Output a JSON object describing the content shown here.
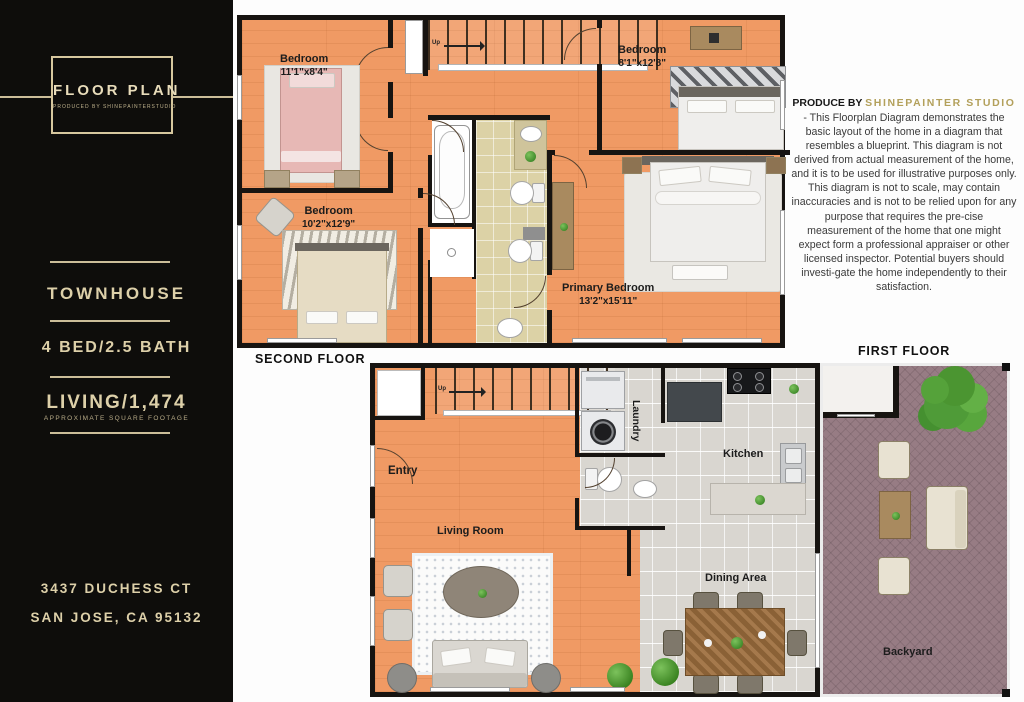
{
  "sidebar": {
    "logo_title": "FLOOR PLAN",
    "logo_subtitle": "PRODUCED BY SHINEPAINTERSTUDIO",
    "property_type": "TOWNHOUSE",
    "bed_bath": "4 BED/2.5 BATH",
    "living": "LIVING/1,474",
    "living_note": "APPROXIMATE SQUARE FOOTAGE",
    "address_line1": "3437 DUCHESS CT",
    "address_line2": "SAN JOSE, CA 95132"
  },
  "disclaimer": {
    "heading_prefix": "PRODUCE BY ",
    "heading_brand": "SHINEPAINTER STUDIO",
    "body": "- This Floorplan Diagram demonstrates the basic layout of the home in a diagram that resembles a blueprint. This diagram is not derived from actual measurement of the home, and it is to be used for illustrative purposes only. This diagram is not to scale, may contain inaccuracies and is not to be relied upon for any purpose that requires the pre-cise measurement of the home that one might expect form a professional appraiser or other licensed inspector. Potential buyers should investi-gate the home independently to their satisfaction."
  },
  "second_floor": {
    "label": "SECOND FLOOR",
    "stairs_label": "Up",
    "bedroom_top_left": {
      "name": "Bedroom",
      "dims": "11'1\"x8'4\""
    },
    "bedroom_mid_left": {
      "name": "Bedroom",
      "dims": "10'2\"x12'9\""
    },
    "bedroom_top_right": {
      "name": "Bedroom",
      "dims": "8'1\"x12'8\""
    },
    "primary_bedroom": {
      "name": "Primary Bedroom",
      "dims": "13'2\"x15'11\""
    }
  },
  "first_floor": {
    "label": "FIRST FLOOR",
    "stairs_label": "Up",
    "entry": "Entry",
    "living_room": "Living Room",
    "laundry": "Laundry",
    "kitchen": "Kitchen",
    "dining_area": "Dining Area",
    "backyard": "Backyard"
  },
  "colors": {
    "sidebar_bg": "#0e0d0b",
    "gold": "#d9cba3",
    "brand_gold": "#b3a05b",
    "wood_floor": "#f09a64",
    "bath_tile": "#dcd2a6",
    "kitchen_tile": "#e7e4de",
    "backyard_paving": "#977c84",
    "wall": "#171411"
  }
}
